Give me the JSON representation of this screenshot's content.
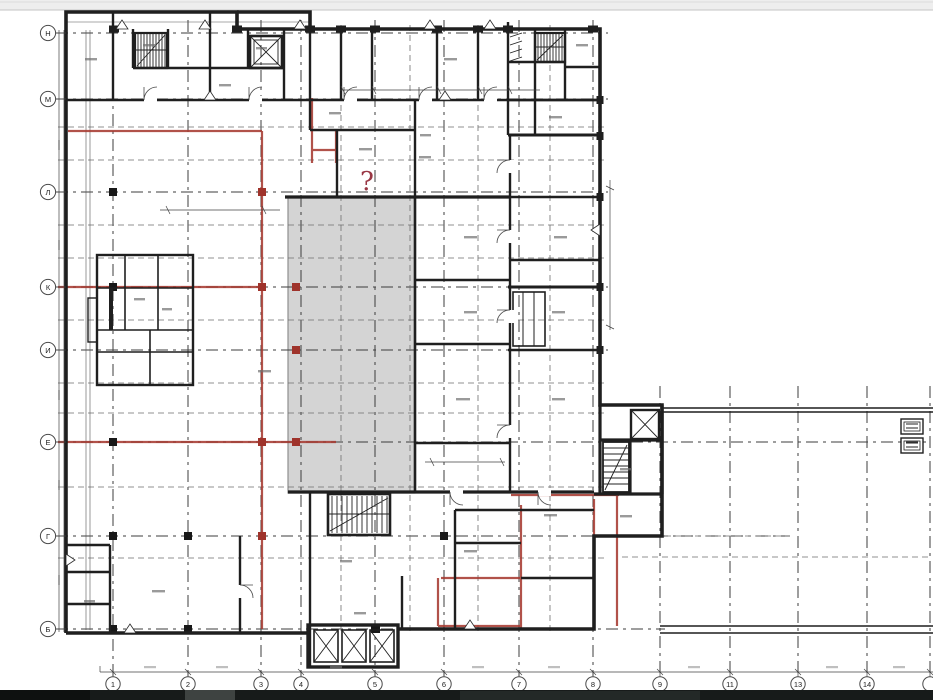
{
  "grid": {
    "column_labels": [
      "1",
      "2",
      "3",
      "4",
      "5",
      "6",
      "7",
      "8",
      "9",
      "11",
      "13",
      "14",
      ""
    ],
    "row_labels": [
      "Н",
      "М",
      "Л",
      "К",
      "И",
      "Е",
      "Г",
      "Б"
    ]
  },
  "annotations": {
    "question_mark": "?"
  },
  "colors": {
    "highlight_red": "#a63a31",
    "atrium_gray": "#d4d4d4",
    "wall_black": "#1f1f1f",
    "top_strip": "#eeeeee",
    "taskbar_dark": "#171b1a"
  }
}
